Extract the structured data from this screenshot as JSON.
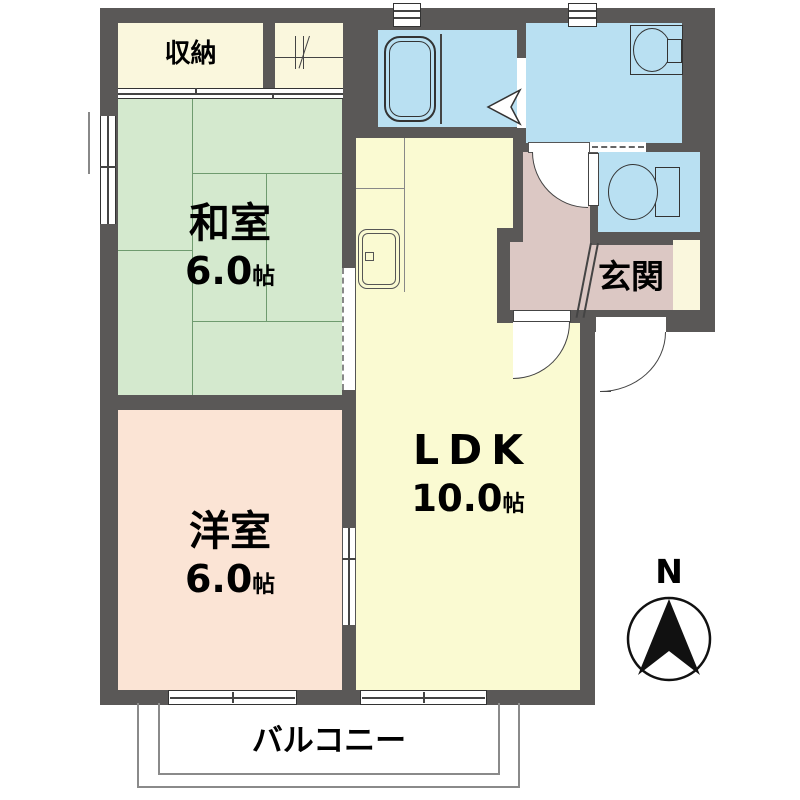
{
  "plan": {
    "rooms": {
      "closet": {
        "label": "収納"
      },
      "japanese_room": {
        "name": "和室",
        "size_value": "6.0",
        "size_unit": "帖"
      },
      "western_room": {
        "name": "洋室",
        "size_value": "6.0",
        "size_unit": "帖"
      },
      "ldk": {
        "name": "LDK",
        "size_value": "10.0",
        "size_unit": "帖"
      },
      "entrance": {
        "name": "玄関"
      },
      "balcony": {
        "name": "バルコニー"
      }
    },
    "compass": {
      "north": "N"
    },
    "fixtures": {
      "bathtub": "bathtub-icon",
      "washbasin": "washbasin-icon",
      "toilet": "toilet-icon",
      "kitchen_sink": "kitchen-sink-icon"
    },
    "colors": {
      "wall": "#5a5857",
      "japanese_room": "#d4e9ce",
      "western_room": "#fbe4d5",
      "ldk": "#fafad2",
      "entrance_hall": "#dcc8c4",
      "wet_area": "#b9e0f2",
      "closet": "#faf7dd"
    }
  }
}
